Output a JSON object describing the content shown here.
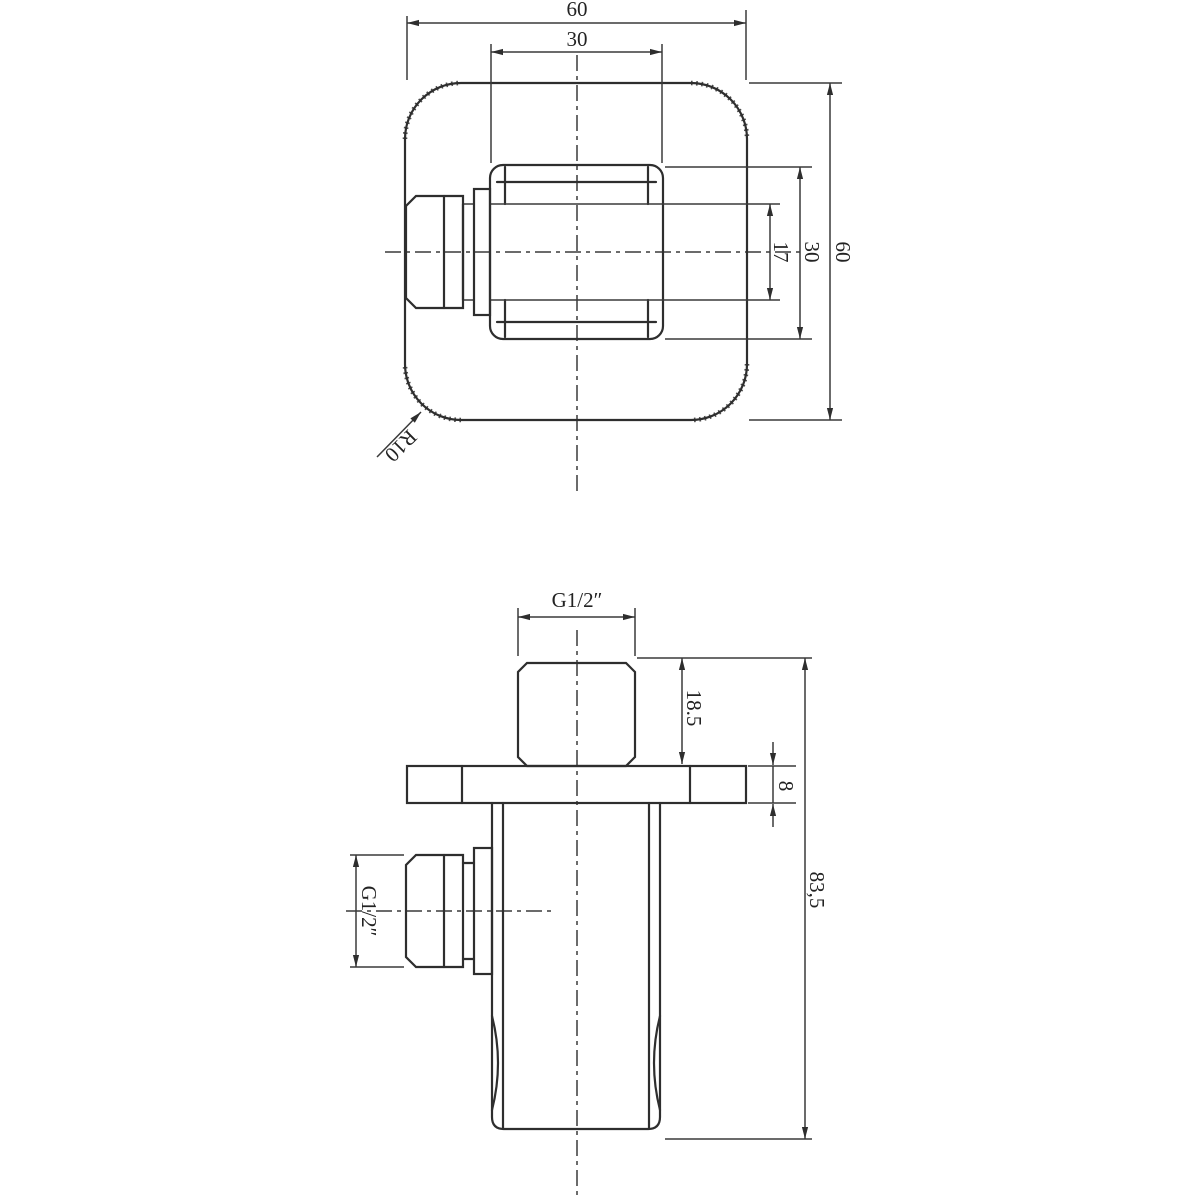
{
  "drawing": {
    "background": "#ffffff",
    "line_color": "#2e2e2e",
    "top_view": {
      "dim_width_outer": "60",
      "dim_width_inner": "30",
      "dim_neck_diameter": "17",
      "dim_body_width": "30",
      "dim_height_outer": "60",
      "radius_label": "R10"
    },
    "front_view": {
      "top_thread_label": "G1/2″",
      "dim_stub_height": "18.5",
      "dim_plate_thickness": "8",
      "dim_total_height": "83,5",
      "side_thread_label": "G1/2″"
    }
  }
}
